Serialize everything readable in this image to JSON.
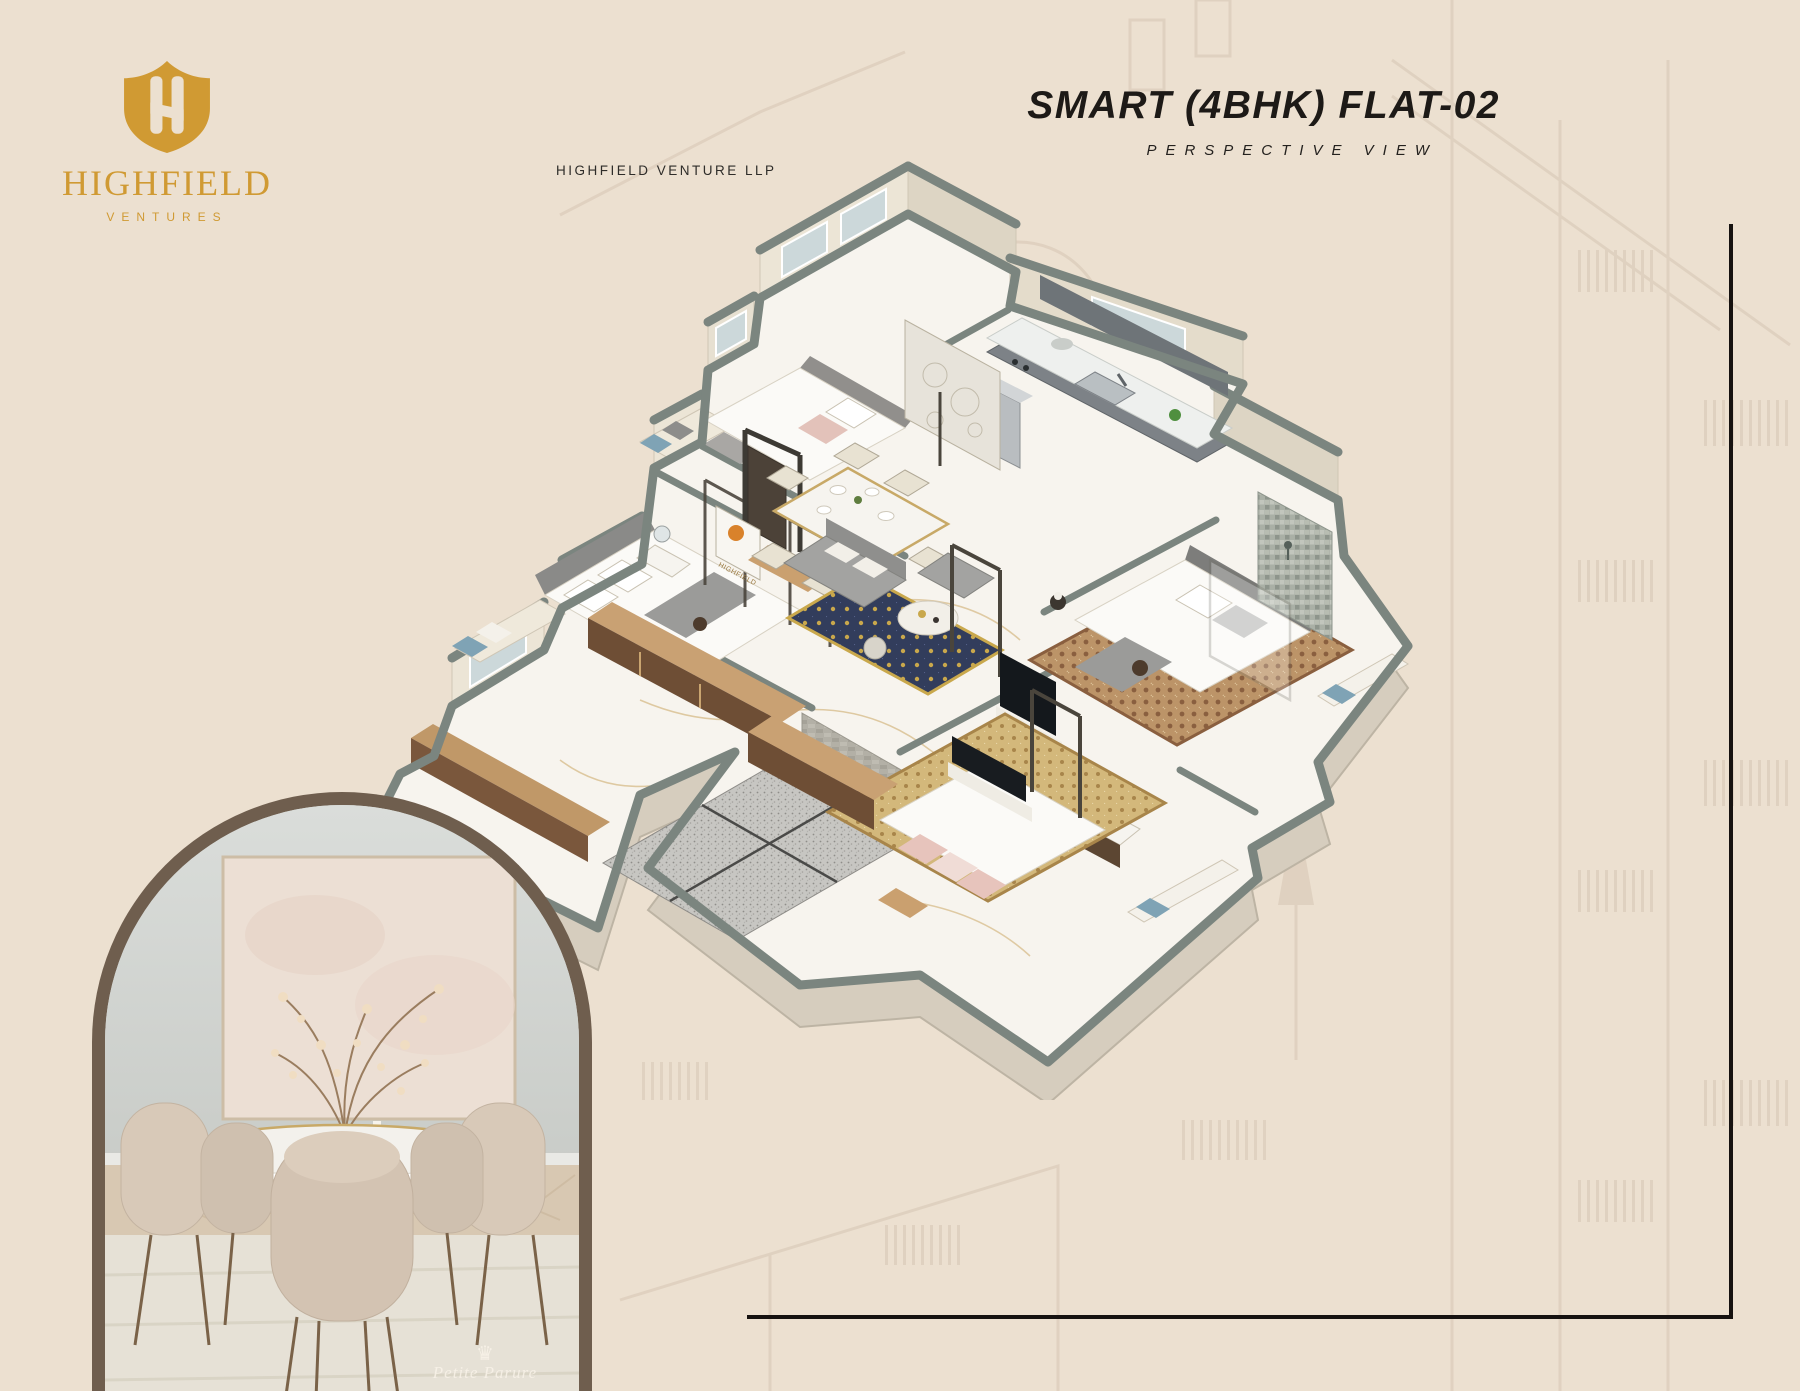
{
  "page": {
    "background": "#ece0d0",
    "frame_line_color": "#161210"
  },
  "brand": {
    "logo_icon": "shield-h-icon",
    "name": "HIGHFIELD",
    "tagline": "VENTURES",
    "gold": "#d09a33"
  },
  "header": {
    "company": "HIGHFIELD VENTURE LLP"
  },
  "title_block": {
    "title": "SMART (4BHK) FLAT-02",
    "subtitle": "PERSPECTIVE VIEW"
  },
  "floor_plan": {
    "type": "isometric-3d-floor-plan",
    "sign_text": "HIGHFIELD",
    "wall_top_color": "#7b857f",
    "wall_face_color": "#ece5d6",
    "floor_color": "#f7f4ee",
    "granite_color": "#c9c8c4",
    "rug_navy": "#323d5c",
    "rug_gold": "#d3b87b",
    "wood_dark": "#6e4e35",
    "wood_light": "#c9a173"
  },
  "photo": {
    "watermark_icon": "crown-icon",
    "watermark_text": "Petite Parure",
    "arch_border_color": "#6f5e4e"
  }
}
